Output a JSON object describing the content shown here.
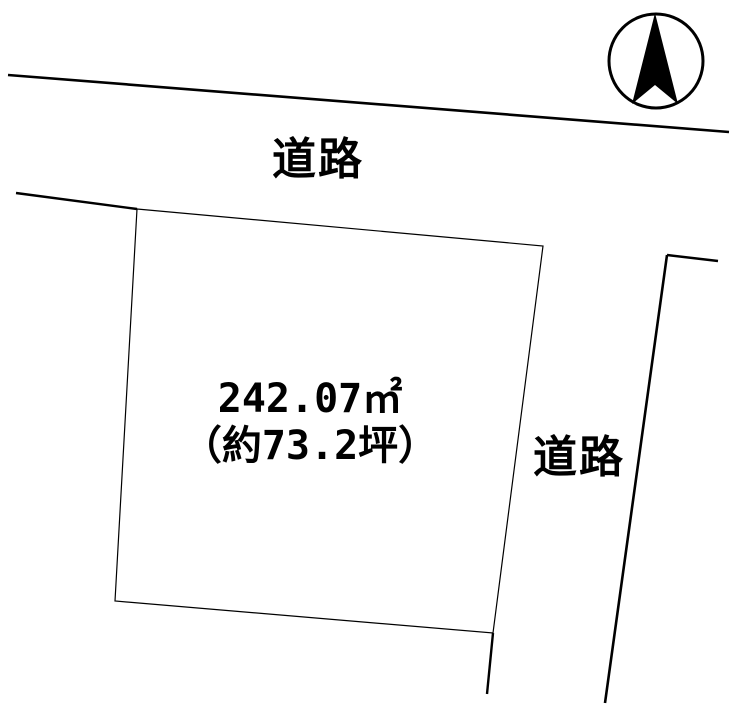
{
  "diagram": {
    "type": "land-plot-map",
    "background_color": "#ffffff",
    "line_color": "#000000",
    "labels": {
      "road_top": "道路",
      "road_right": "道路",
      "parcel_area_m2": "242.07㎡",
      "parcel_area_tsubo": "（約73.2坪）"
    },
    "compass": {
      "meaning": "north-arrow",
      "direction": "up"
    },
    "parcel": {
      "area_m2": 242.07,
      "area_tsubo_approx": 73.2
    }
  }
}
